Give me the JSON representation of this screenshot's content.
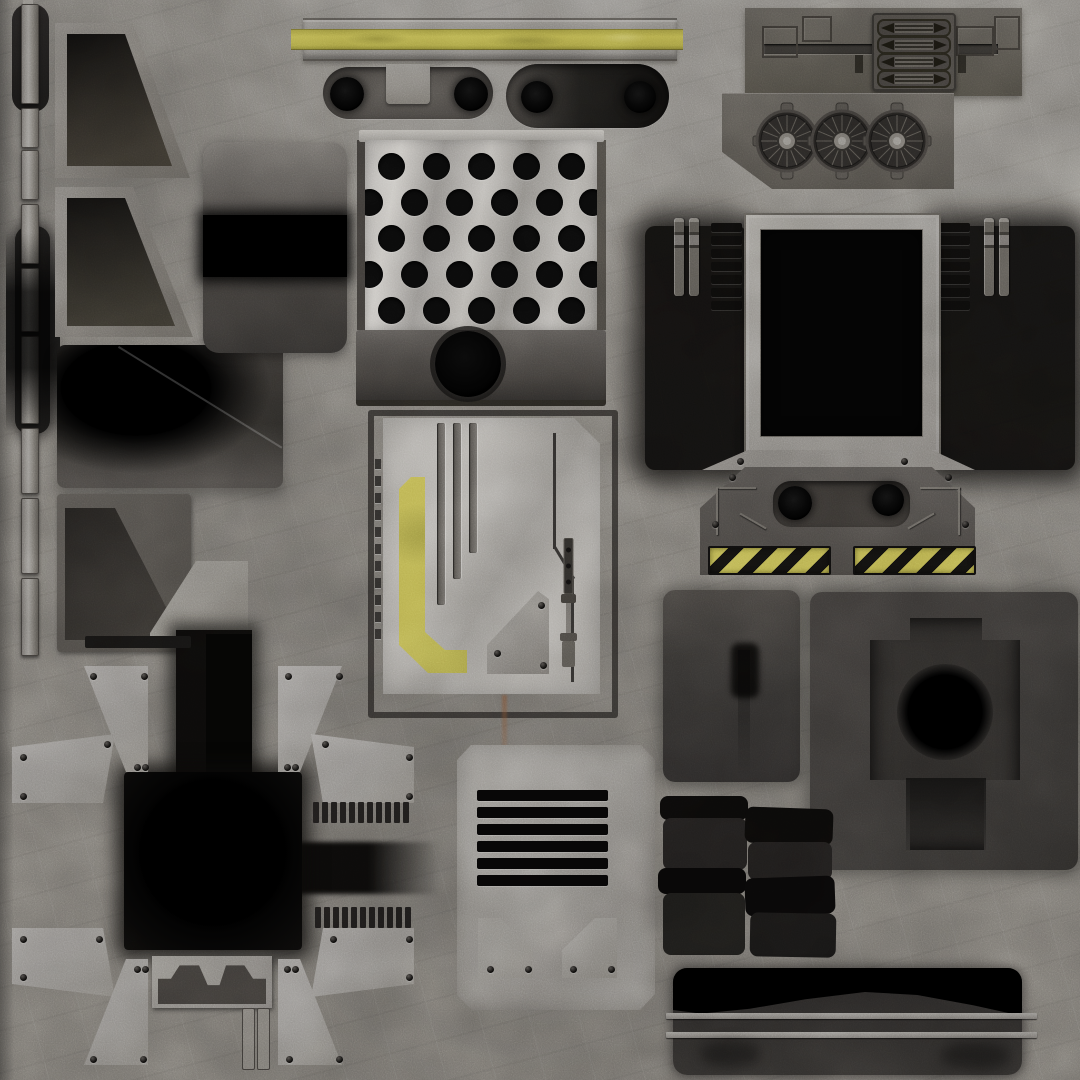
{
  "meta": {
    "type": "texture-atlas",
    "subject": "sci-fi metal and concrete panel texture sheet",
    "width_px": 1080,
    "height_px": 1080
  },
  "palette": {
    "concrete_base": "#7c7975",
    "concrete_light": "#918e89",
    "concrete_dark": "#5e5b57",
    "metal_light": "#b6b3ae",
    "metal_mid": "#8e8b86",
    "metal_dark": "#55524e",
    "panel_dark": "#3b3835",
    "near_black": "#141312",
    "black": "#000000",
    "accent_yellow": "#b3aa4a",
    "accent_yellow_dark": "#8f8836",
    "rust": "#7a4a2a"
  },
  "components": {
    "left_rail": {
      "x": 21,
      "width": 16,
      "segments": [
        [
          4,
          98
        ],
        [
          108,
          38
        ],
        [
          150,
          48
        ],
        [
          204,
          58
        ],
        [
          268,
          62
        ],
        [
          336,
          86
        ],
        [
          428,
          64
        ],
        [
          498,
          74
        ],
        [
          578,
          76
        ]
      ]
    },
    "perforated_plate": {
      "hole_diameter": 27,
      "rows": [
        {
          "y": 166,
          "xs": [
            391,
            436,
            481,
            526,
            571
          ]
        },
        {
          "y": 202,
          "xs": [
            369,
            414,
            459,
            504,
            549,
            592
          ]
        },
        {
          "y": 238,
          "xs": [
            391,
            436,
            481,
            526,
            571
          ]
        },
        {
          "y": 274,
          "xs": [
            369,
            414,
            459,
            504,
            549,
            592
          ]
        },
        {
          "y": 310,
          "xs": [
            391,
            436,
            481,
            526,
            571
          ]
        }
      ]
    },
    "tick_strip": {
      "count": 11,
      "x": 375,
      "y": 459,
      "step": 17,
      "w": 6,
      "h": 10
    },
    "window_ladders": {
      "bars_per_side": 7,
      "bar_w": 31,
      "bar_h": 9,
      "gap": 4,
      "left_x": 711,
      "right_x": 939,
      "y": 223
    },
    "window_rods": {
      "xs": [
        674,
        689,
        984,
        999
      ],
      "y": 218
    },
    "vent": {
      "slats": 6,
      "x": 477,
      "y": 790,
      "w": 131,
      "h": 11,
      "gap": 6
    },
    "turbine_panel": {
      "count": 3,
      "centers_x": [
        787,
        842,
        897
      ],
      "center_y": 141,
      "radius": 29,
      "spokes": 16
    },
    "bullet_block": {
      "rows": 4,
      "row_h": 14,
      "row_gap": 3,
      "top": 4
    },
    "hazard_strips": {
      "strips": [
        {
          "x": 708
        },
        {
          "x": 853
        }
      ],
      "y": 546,
      "w": 119,
      "h": 25
    },
    "comb_strips": {
      "rows": [
        {
          "x": 313,
          "y": 802
        },
        {
          "x": 315,
          "y": 907
        }
      ],
      "teeth": 11,
      "tooth_w": 6,
      "tooth_h": 21,
      "gap": 3
    },
    "capsule_holes": {
      "left": {
        "cy": 94,
        "cx": [
          347,
          471
        ],
        "r": 17
      },
      "right": {
        "cy": 97,
        "cx": [
          537,
          640
        ],
        "r": 16
      }
    },
    "black_stack": {
      "bars": [
        [
          660,
          796,
          88,
          24,
          "#0a0908",
          0
        ],
        [
          663,
          818,
          84,
          52,
          "#1e1c1b",
          0
        ],
        [
          658,
          868,
          88,
          26,
          "#070606",
          0
        ],
        [
          663,
          893,
          82,
          62,
          "#1b1a18",
          0
        ],
        [
          745,
          808,
          88,
          36,
          "#0a0908",
          2
        ],
        [
          748,
          842,
          84,
          38,
          "#1d1b1a",
          0
        ],
        [
          745,
          877,
          90,
          38,
          "#080707",
          -2
        ],
        [
          750,
          913,
          86,
          44,
          "#161514",
          1
        ]
      ]
    },
    "bottom_bar_lines": {
      "ys": [
        1013,
        1032
      ],
      "x": 666,
      "w": 371
    }
  }
}
